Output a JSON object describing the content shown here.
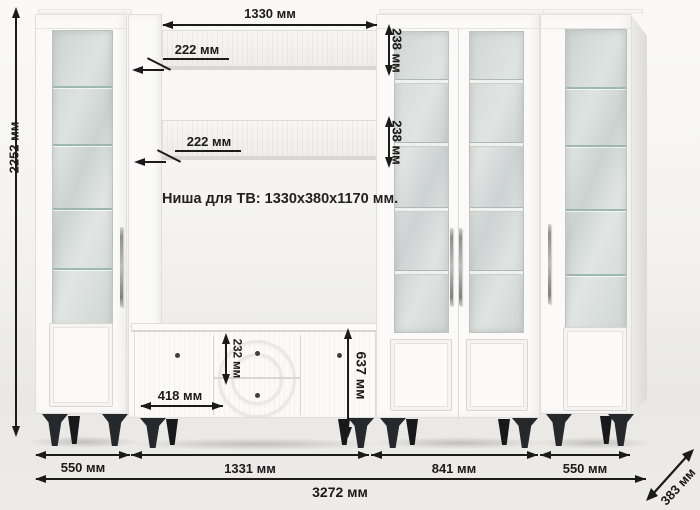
{
  "note": {
    "tv_niche": "Ниша для ТВ: 1330x380x1170 мм."
  },
  "dims": {
    "total_height": "2252 мм",
    "niche_width": "1330 мм",
    "shelf_depth_top": "222 мм",
    "shelf_depth_mid": "222 мм",
    "shelf_front_top": "238 мм",
    "shelf_front_mid": "238 мм",
    "drawer_height": "232 мм",
    "stand_door_width": "418 мм",
    "stand_height": "637 мм",
    "seg_left_cabinet": "550 мм",
    "seg_tv_unit": "1331 мм",
    "seg_bookcase": "841 мм",
    "seg_right_cabinet": "550 мм",
    "total_width": "3272 мм",
    "total_depth": "383 мм"
  },
  "colors": {
    "dimension_ink": "#1b1b1b",
    "furniture_white": "#fbfaf8",
    "glass_tint": "#d2d9d7",
    "glass_shelf_line": "#9fb7b1",
    "leg_black": "#26292c"
  }
}
